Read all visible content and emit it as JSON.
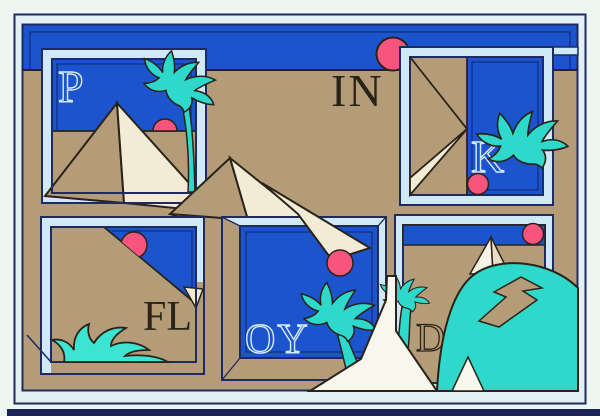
{
  "artwork": {
    "letters": {
      "p": "P",
      "in": "IN",
      "k": "K",
      "fl": "FL",
      "oy": "OY",
      "d": "D"
    },
    "palette": {
      "sky_blue": "#1b54cc",
      "pinstripe_navy": "#12307c",
      "frame_navy": "#1e2a60",
      "sand_tan": "#b59c78",
      "frame_pale_blue": "#cfe9f7",
      "margin_white": "#eef6f1",
      "palm_teal": "#2ed9cb",
      "bush_turquoise": "#3ce4d4",
      "sun_pink": "#f8547e",
      "pyramid_cream": "#f2ecd7",
      "walkway_white": "#f7f7ee",
      "outline_dark": "#2a2318",
      "bottom_edge_navy": "#1c2455",
      "pale_letter_blue": "#d6ebfa"
    }
  }
}
